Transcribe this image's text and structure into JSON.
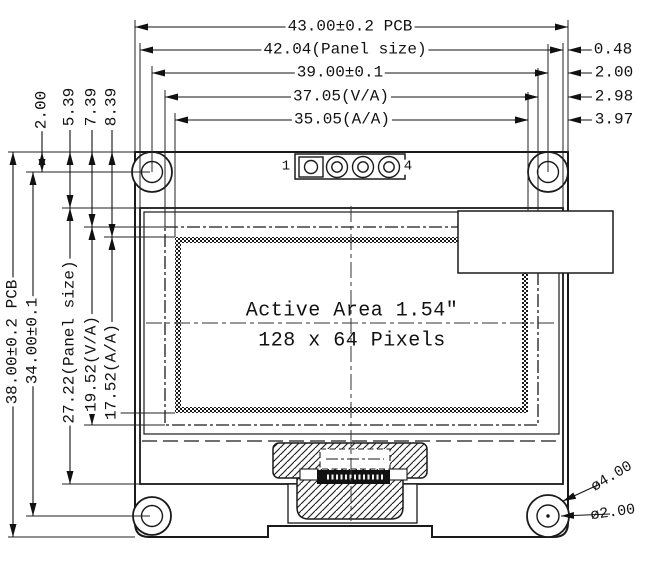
{
  "title": "OLED module outline drawing",
  "dimensions": {
    "top": [
      {
        "label": "43.00±0.2 PCB"
      },
      {
        "label": "42.04(Panel size)"
      },
      {
        "label": "39.00±0.1"
      },
      {
        "label": "37.05(V/A)"
      },
      {
        "label": "35.05(A/A)"
      }
    ],
    "right": [
      {
        "label": "0.48"
      },
      {
        "label": "2.00"
      },
      {
        "label": "2.98"
      },
      {
        "label": "3.97"
      }
    ],
    "left_top": [
      {
        "label": "2.00"
      },
      {
        "label": "5.39"
      },
      {
        "label": "7.39"
      },
      {
        "label": "8.39"
      }
    ],
    "left": [
      {
        "label": "38.00±0.2 PCB"
      },
      {
        "label": "34.00±0.1"
      },
      {
        "label": "27.22(Panel size)"
      },
      {
        "label": "19.52(V/A)"
      },
      {
        "label": "17.52(A/A)"
      }
    ],
    "holes": [
      {
        "label": "ø4.00"
      },
      {
        "label": "ø2.00"
      }
    ]
  },
  "display": {
    "active_area_line1": "Active Area 1.54″",
    "active_area_line2": "128 x 64 Pixels"
  },
  "connector": {
    "pin_first": "1",
    "pin_last": "4"
  },
  "colors": {
    "line": "#1a1a1a",
    "background": "#ffffff"
  }
}
